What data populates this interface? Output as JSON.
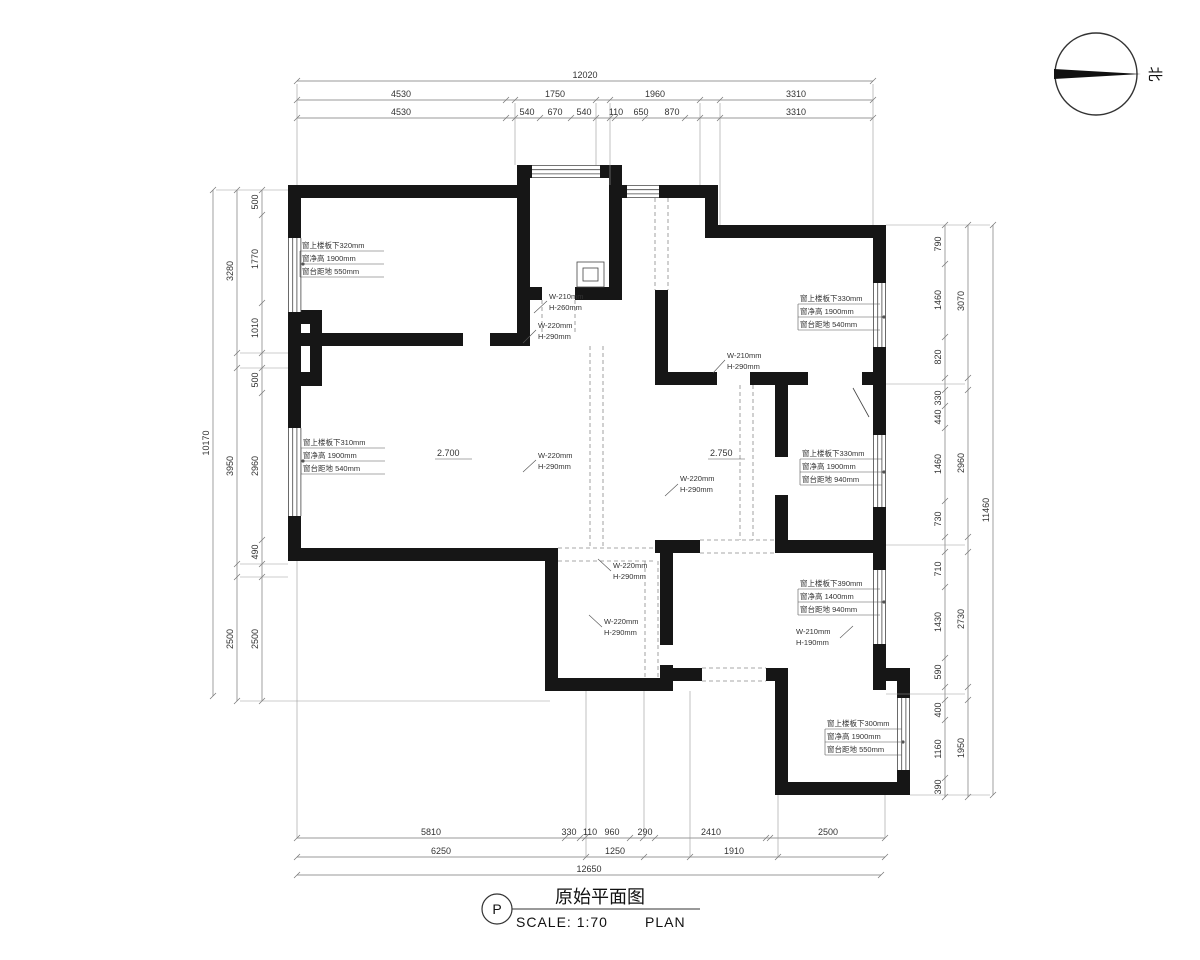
{
  "title_block": {
    "mark": "P",
    "title": "原始平面图",
    "scale_label": "SCALE: 1:70",
    "plan_label": "PLAN"
  },
  "north": {
    "label": "北"
  },
  "levels": {
    "living": "2.700",
    "hall": "2.750"
  },
  "dims": {
    "top": {
      "total": "12020",
      "row2": [
        "4530",
        "1750",
        "1960",
        "3310"
      ],
      "row3": [
        "4530",
        "540",
        "670",
        "540",
        "110",
        "650",
        "870",
        "3310"
      ]
    },
    "bottom": {
      "row1": [
        "5810",
        "330",
        "110",
        "960",
        "290",
        "2410",
        "2500"
      ],
      "row2": [
        "6250",
        "1250",
        "1910"
      ],
      "total": "12650"
    },
    "left": {
      "total": "10170",
      "mid": [
        "3280",
        "3950",
        "2500"
      ],
      "inner": [
        "500",
        "1770",
        "1010",
        "500",
        "2960",
        "490",
        "2500"
      ]
    },
    "right": {
      "total": "11460",
      "mid": [
        "3070",
        "2960",
        "2730",
        "1950"
      ],
      "inner": [
        "790",
        "1460",
        "820",
        "330",
        "440",
        "1460",
        "730",
        "710",
        "1430",
        "590",
        "400",
        "1160",
        "390"
      ]
    }
  },
  "window_notes": [
    {
      "l1": "窗上楼板下320mm",
      "l2": "窗净高  1900mm",
      "l3": "窗台距地  550mm"
    },
    {
      "l1": "窗上楼板下310mm",
      "l2": "窗净高  1900mm",
      "l3": "窗台距地  540mm"
    },
    {
      "l1": "窗上楼板下330mm",
      "l2": "窗净高  1900mm",
      "l3": "窗台距地  540mm"
    },
    {
      "l1": "窗上楼板下330mm",
      "l2": "窗净高  1900mm",
      "l3": "窗台距地  940mm"
    },
    {
      "l1": "窗上楼板下390mm",
      "l2": "窗净高  1400mm",
      "l3": "窗台距地  940mm"
    },
    {
      "l1": "窗上楼板下300mm",
      "l2": "窗净高  1900mm",
      "l3": "窗台距地  550mm"
    }
  ],
  "opening_notes": [
    {
      "w": "W-210mm",
      "h": "H-260mm"
    },
    {
      "w": "W-220mm",
      "h": "H-290mm"
    },
    {
      "w": "W-210mm",
      "h": "H-290mm"
    },
    {
      "w": "W-220mm",
      "h": "H-290mm"
    },
    {
      "w": "W-220mm",
      "h": "H-290mm"
    },
    {
      "w": "W-220mm",
      "h": "H-290mm"
    },
    {
      "w": "W-220mm",
      "h": "H-290mm"
    },
    {
      "w": "W-210mm",
      "h": "H-190mm"
    }
  ]
}
